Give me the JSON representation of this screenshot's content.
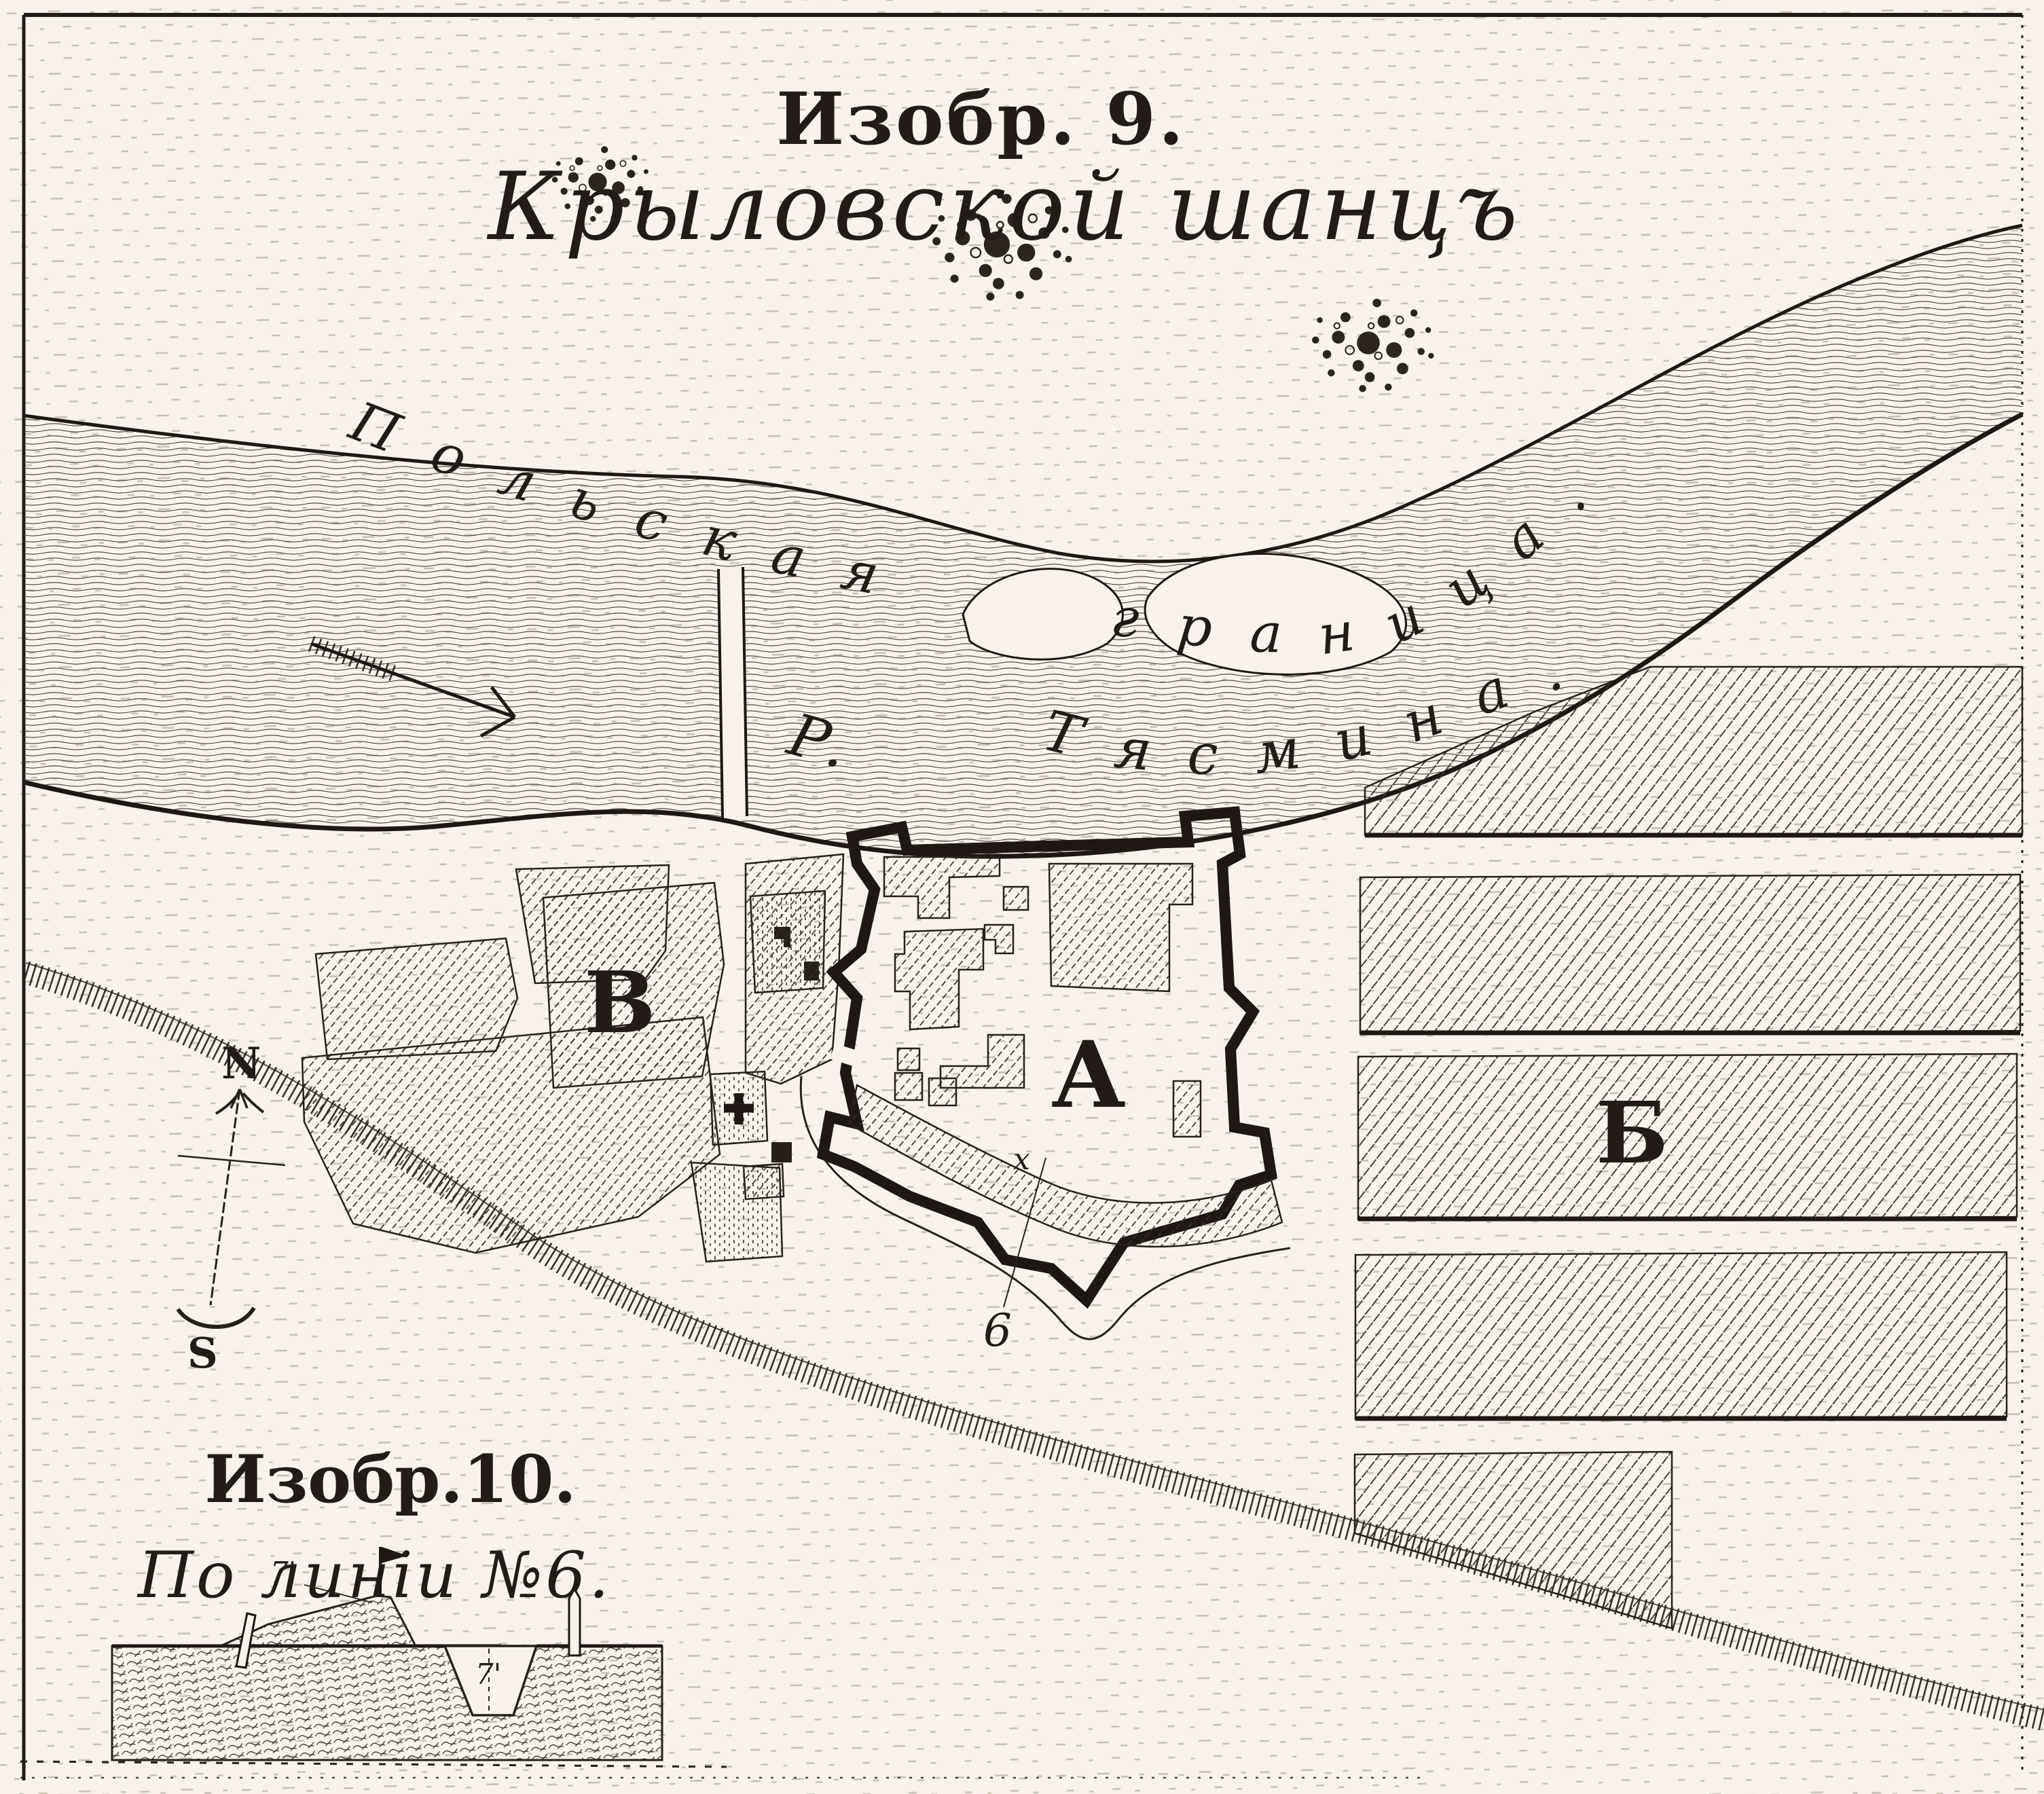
{
  "figure9": {
    "caption": "Изобр. 9.",
    "title": "Крыловской шанцъ"
  },
  "map": {
    "boundary_label": "Польская граница.",
    "river": {
      "abbrev": "Р.",
      "name": "Тясмина."
    },
    "citadel_label": "А",
    "field_strips_label": "Б",
    "suburb_label": "В",
    "profile_line_number": "6",
    "rampart_crossing_mark": "х",
    "compass": {
      "north": "N",
      "south": "S"
    }
  },
  "figure10": {
    "caption": "Изобр.10.",
    "title": "По линіи №6.",
    "measurements": {
      "parapet": "7'",
      "ditch": "7'"
    }
  },
  "colors": {
    "paper": "#f5f3eb",
    "ink": "#201d18"
  }
}
